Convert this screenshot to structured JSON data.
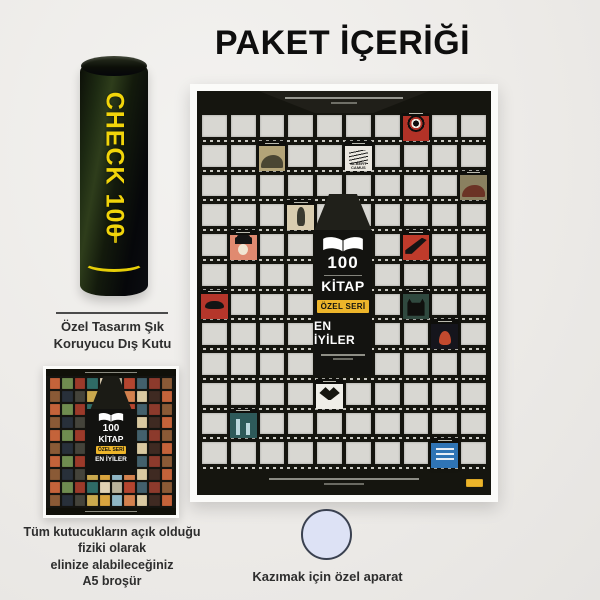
{
  "page": {
    "title": "PAKET İÇERİĞİ"
  },
  "colors": {
    "gold": "#edb52a",
    "tube_yellow": "#f2d50a",
    "poster_bg": "#15150f",
    "box": "#d8d7d2",
    "circle_fill": "#dde2f5"
  },
  "tube": {
    "label": "CHECK 100",
    "caption_lines": [
      "Özel Tasarım Şık",
      "Koruyucu Dış Kutu"
    ]
  },
  "brochure": {
    "caption_lines": [
      "Tüm kutucukların açık olduğu",
      "fiziki olarak",
      "elinize alabileceğiniz",
      "A5 broşür"
    ],
    "palette": [
      "#c4633a",
      "#d9a43e",
      "#8c3a2c",
      "#2f6b66",
      "#d9c9a1",
      "#44433a",
      "#b4452f",
      "#6f8c50",
      "#8fb6c4",
      "#8a5a36",
      "#e0d2b4",
      "#3f2a22",
      "#c9a84d",
      "#43606c",
      "#9c3a2a",
      "#d3814e",
      "#28303a",
      "#b8b29a"
    ]
  },
  "poster": {
    "title_number": "100",
    "title_word": "KİTAP",
    "badge": "ÖZEL SERİ",
    "subtitle": "EN İYİLER",
    "grid": {
      "rows": 12,
      "cols": 10
    },
    "covers": [
      {
        "row": 1,
        "col": 8,
        "shape": "eye",
        "bg": "#b23227",
        "fg": "#101010"
      },
      {
        "row": 2,
        "col": 3,
        "shape": "mound",
        "bg": "#b3a478",
        "fg": "#4a4633"
      },
      {
        "row": 2,
        "col": 6,
        "shape": "scribble",
        "bg": "#e9e6df",
        "fg": "#1c1c1c",
        "label": "ALBERT CAMUS"
      },
      {
        "row": 3,
        "col": 10,
        "shape": "mound",
        "bg": "#8a8060",
        "fg": "#6b3325"
      },
      {
        "row": 4,
        "col": 4,
        "shape": "figure",
        "bg": "#d9cdb0",
        "fg": "#3a3a30"
      },
      {
        "row": 5,
        "col": 2,
        "shape": "hatface",
        "bg": "#e08a70",
        "fg": "#151515"
      },
      {
        "row": 5,
        "col": 8,
        "shape": "wing",
        "bg": "#bf3b2b",
        "fg": "#141414"
      },
      {
        "row": 7,
        "col": 1,
        "shape": "boa",
        "bg": "#b5362b",
        "fg": "#141414"
      },
      {
        "row": 7,
        "col": 8,
        "shape": "cat",
        "bg": "#30493f",
        "fg": "#10100e"
      },
      {
        "row": 8,
        "col": 9,
        "shape": "flame",
        "bg": "#15151c",
        "fg": "#c24a2e"
      },
      {
        "row": 10,
        "col": 5,
        "shape": "seagull",
        "bg": "#efeee8",
        "fg": "#15150f"
      },
      {
        "row": 11,
        "col": 2,
        "shape": "towers",
        "bg": "#2e5a5a",
        "fg": "#bcd8de"
      },
      {
        "row": 12,
        "col": 9,
        "shape": "textlines",
        "bg": "#2f74b5",
        "fg": "#e8eef5"
      }
    ]
  },
  "scratch_tool": {
    "caption": "Kazımak için özel aparat"
  }
}
